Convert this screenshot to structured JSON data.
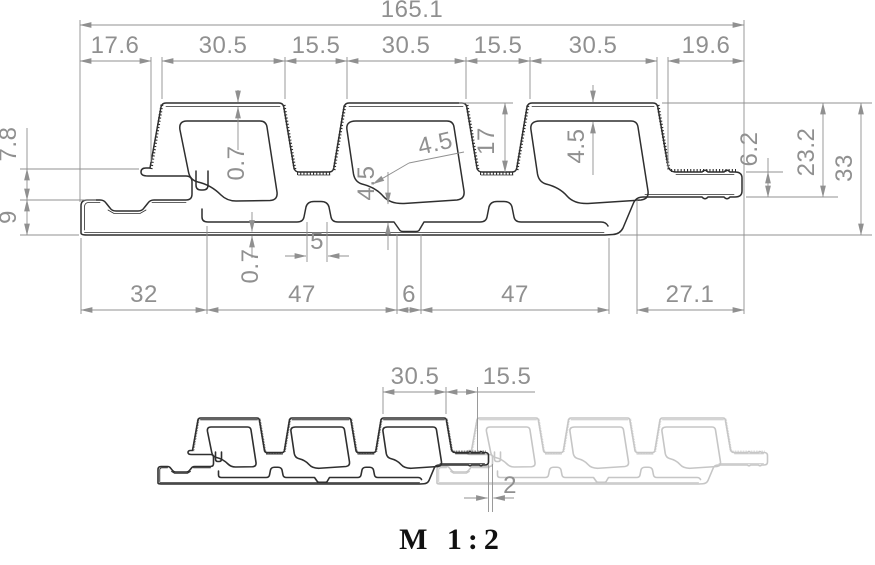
{
  "drawing": {
    "main_dims": {
      "overall_width": "165.1",
      "seg_17_6": "17.6",
      "seg_30_5_a": "30.5",
      "seg_15_5_a": "15.5",
      "seg_30_5_b": "30.5",
      "seg_15_5_b": "15.5",
      "seg_30_5_c": "30.5",
      "seg_19_6": "19.6",
      "left_7_8": "7.8",
      "left_9": "9",
      "skin_top": "0.7",
      "skin_bottom": "0.7",
      "wall_a": "4.5",
      "wall_b": "4.5",
      "wall_c": "4.5",
      "rib_height": "17",
      "bump_width": "5",
      "right_6_2": "6.2",
      "right_23_2": "23.2",
      "right_33": "33",
      "bot_32": "32",
      "bot_47_a": "47",
      "bot_6": "6",
      "bot_47_b": "47",
      "bot_27_1": "27.1"
    },
    "detail_dims": {
      "rib_30_5": "30.5",
      "joint_15_5": "15.5",
      "gap_2": "2"
    },
    "scale_label": "M 1:2"
  },
  "colors": {
    "line": "#2f2f2f",
    "ghost": "#c6c6c6",
    "dim": "#909090",
    "scale_text": "#111111",
    "bg": "#ffffff"
  }
}
